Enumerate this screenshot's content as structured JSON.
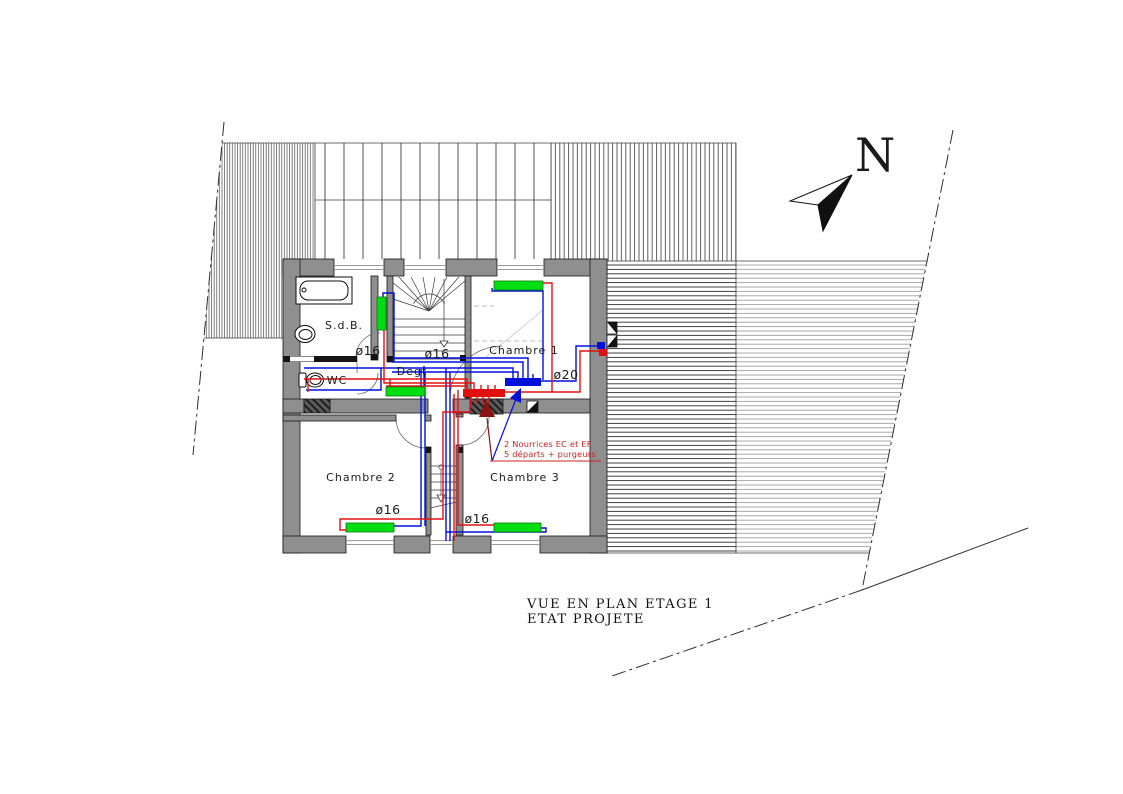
{
  "drawing": {
    "title_line1": "VUE EN PLAN ETAGE 1",
    "title_line2": "ETAT PROJETE",
    "north_label": "N"
  },
  "rooms": {
    "sdb": "S.d.B.",
    "wc": "WC",
    "degt": "Degt",
    "chambre1": "Chambre 1",
    "chambre2": "Chambre 2",
    "chambre3": "Chambre 3"
  },
  "pipe_labels": {
    "sdb": "ø16",
    "stairs": "ø16",
    "chambre1": "ø20",
    "chambre2": "ø16",
    "chambre3": "ø16"
  },
  "annotation": {
    "line1": "2 Nourrices EC et EF",
    "line2": "5 départs + purgeurs"
  },
  "colors": {
    "wall": "#8f8f8f",
    "pipe_blue": "#0010dc",
    "pipe_red": "#e01010",
    "radiator_green": "#00dd11",
    "annotation_red": "#cc2222",
    "arrow_dark_red": "#8b1212"
  }
}
